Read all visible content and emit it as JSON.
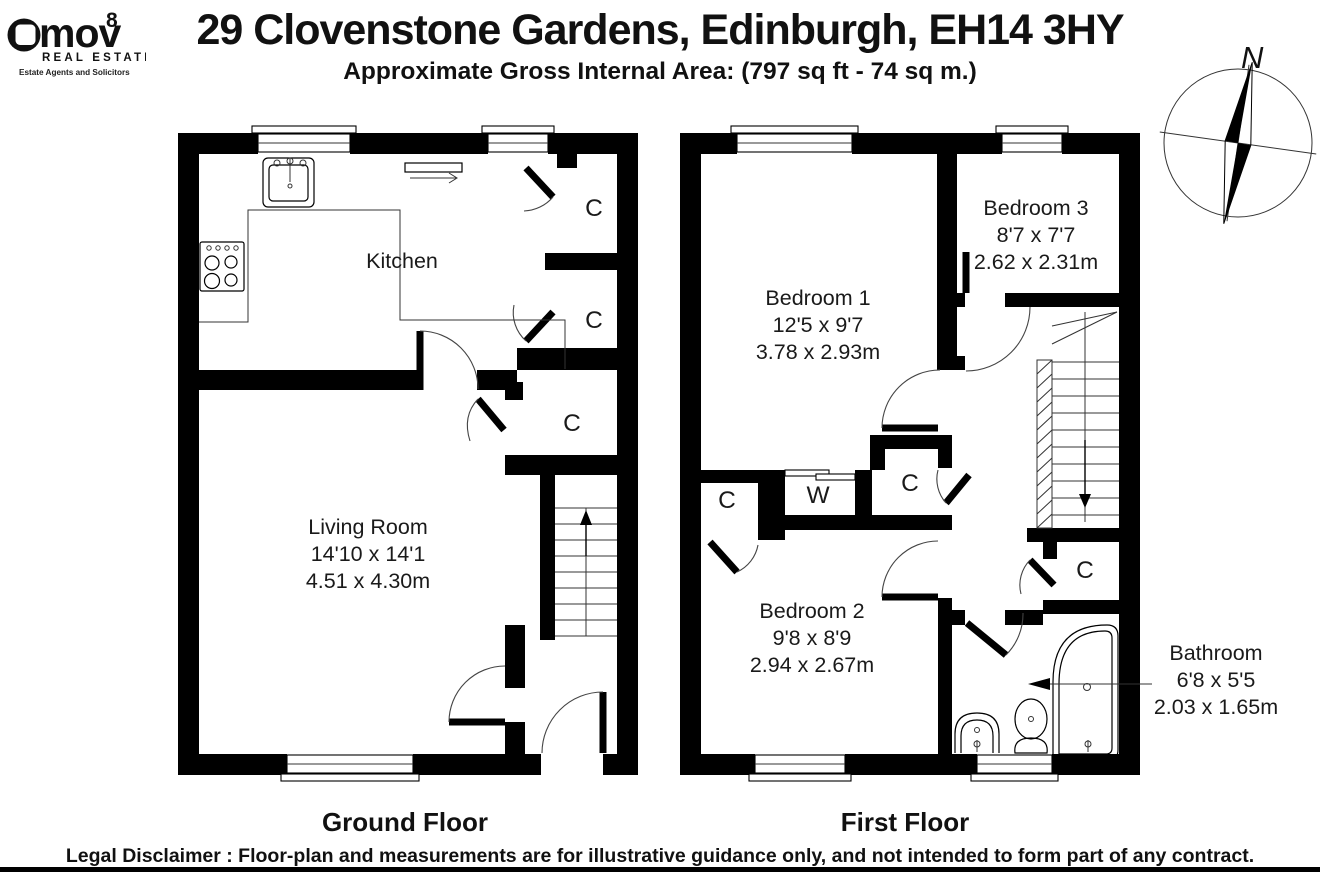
{
  "header": {
    "logo": {
      "brand": "mov",
      "superscript": "8",
      "tagline": "REAL ESTATE",
      "subtagline": "Estate Agents and Solicitors"
    },
    "title": "29 Clovenstone Gardens, Edinburgh, EH14 3HY",
    "subtitle": "Approximate Gross Internal Area: (797 sq ft - 74 sq m.)"
  },
  "compass": {
    "north_label": "N"
  },
  "ground_floor": {
    "title": "Ground Floor",
    "kitchen": {
      "name": "Kitchen"
    },
    "living_room": {
      "name": "Living Room",
      "imperial": "14'10 x 14'1",
      "metric": "4.51 x 4.30m"
    },
    "closets": [
      "C",
      "C",
      "C"
    ]
  },
  "first_floor": {
    "title": "First Floor",
    "bedroom1": {
      "name": "Bedroom 1",
      "imperial": "12'5 x 9'7",
      "metric": "3.78 x 2.93m"
    },
    "bedroom3": {
      "name": "Bedroom 3",
      "imperial": "8'7 x 7'7",
      "metric": "2.62 x 2.31m"
    },
    "bedroom2": {
      "name": "Bedroom 2",
      "imperial": "9'8 x 8'9",
      "metric": "2.94 x 2.67m"
    },
    "bathroom": {
      "name": "Bathroom",
      "imperial": "6'8 x 5'5",
      "metric": "2.03 x 1.65m"
    },
    "closets": [
      "C",
      "W",
      "C",
      "C"
    ]
  },
  "footer": {
    "disclaimer": "Legal Disclaimer : Floor-plan and measurements are for illustrative guidance only, and not intended to form part of any contract."
  }
}
